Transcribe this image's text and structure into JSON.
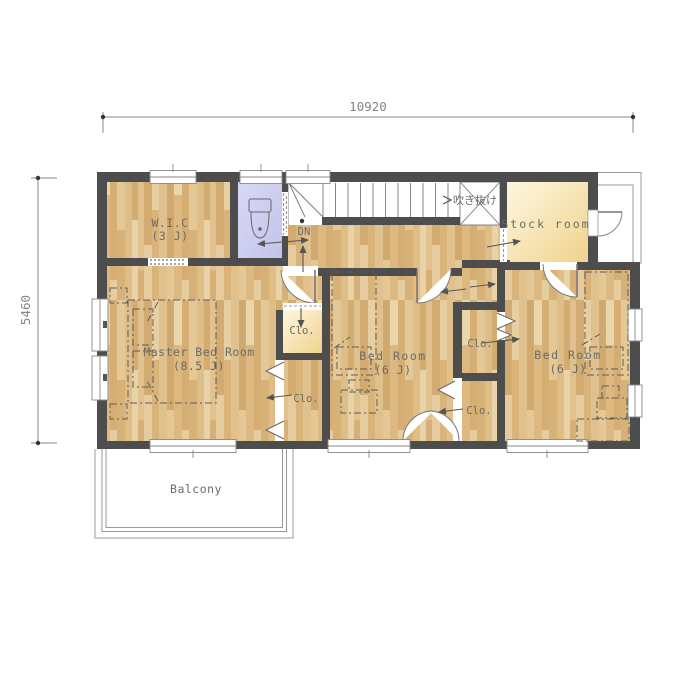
{
  "plan": {
    "dimension_top": "10920",
    "dimension_left": "5460",
    "rooms": {
      "wic": {
        "name": "W.I.C",
        "size": "(3 J)"
      },
      "stock_room": {
        "name": "Stock room"
      },
      "master_bedroom": {
        "name": "Master Bed Room",
        "size": "(8.5 J)"
      },
      "bedroom_center": {
        "name": "Bed Room",
        "size": "(6 J)"
      },
      "bedroom_right": {
        "name": "Bed Room",
        "size": "(6 J)"
      },
      "balcony": {
        "name": "Balcony"
      }
    },
    "labels": {
      "closet": "Clo.",
      "down": "DN",
      "void": "吹き抜け"
    },
    "colors": {
      "wall": "#4d4d4d",
      "wood_floor": "#dcba83",
      "cream_floor": "#f3dc9e",
      "lavender_floor": "#cacaef",
      "thin_line": "#8a8a8a",
      "text": "#6b6b66"
    }
  }
}
